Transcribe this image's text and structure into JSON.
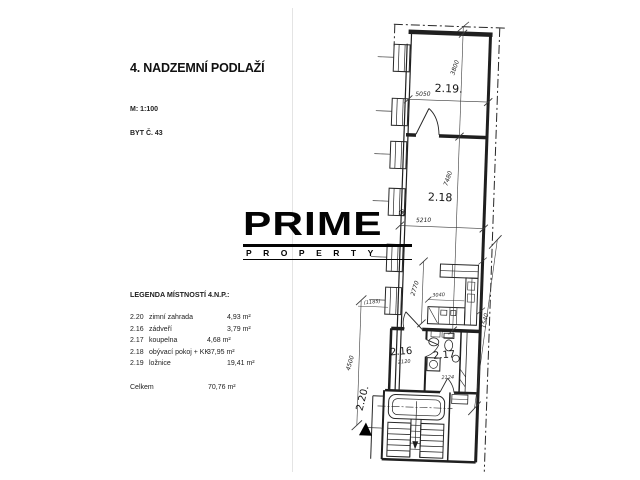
{
  "info_panel": {
    "title": "4. NADZEMNÍ PODLAŽÍ",
    "scale": "M: 1:100",
    "unit": "BYT Č. 43",
    "legend": {
      "heading": "LEGENDA MÍSTNOSTÍ 4.N.P.:",
      "rows": [
        {
          "code": "2.20",
          "name": "zimní zahrada",
          "area": "4,93 m²"
        },
        {
          "code": "2.16",
          "name": "zádveří",
          "area": "3,79 m²"
        },
        {
          "code": "2.17",
          "name": "koupelna",
          "area": "4,68 m²"
        },
        {
          "code": "2.18",
          "name": "obývací pokoj + KK",
          "area": "37,95 m²"
        },
        {
          "code": "2.19",
          "name": "ložnice",
          "area": "19,41 m²"
        }
      ],
      "total_label": "Celkem",
      "total_area": "70,76 m²"
    }
  },
  "logo": {
    "brand": "PRIME",
    "subbrand": "PROPERTY",
    "registered": "®",
    "color": "#030303"
  },
  "floor_plan": {
    "rooms": {
      "r219": "2.19.",
      "r218": "2.18",
      "r216": "2.16",
      "r217": "2.17",
      "r220": "2.20."
    },
    "dims": {
      "w219": "5050",
      "h219": "3800",
      "w218": "5210",
      "h218": "7480",
      "kitchen_h": "2770",
      "kitchen_w": "3040",
      "w216": "2120",
      "w217": "2124",
      "terrace_h": "4500",
      "right_side": "1540",
      "left_small": "(1185)"
    }
  }
}
